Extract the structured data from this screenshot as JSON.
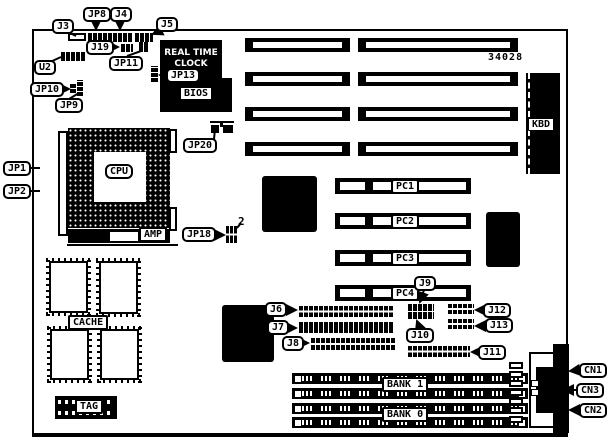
{
  "board": {
    "part_number": "34028",
    "silkscreen": {
      "rtc_line1": "REAL TIME",
      "rtc_line2": "CLOCK",
      "bios": "BIOS",
      "cpu": "CPU",
      "amp": "AMP",
      "kbd": "KBD",
      "cache": "CACHE",
      "tag": "TAG",
      "bank1": "BANK 1",
      "bank0": "BANK 0",
      "pin2": "2"
    },
    "connector_labels": {
      "j3": "J3",
      "jp8": "JP8",
      "j4": "J4",
      "j5": "J5",
      "j19": "J19",
      "jp11": "JP11",
      "u2": "U2",
      "jp10": "JP10",
      "jp9": "JP9",
      "jp13": "JP13",
      "jp20": "JP20",
      "jp1": "JP1",
      "jp2": "JP2",
      "jp18": "JP18",
      "pc1": "PC1",
      "pc2": "PC2",
      "pc3": "PC3",
      "pc4": "PC4",
      "j6": "J6",
      "j7": "J7",
      "j8": "J8",
      "j9": "J9",
      "j10": "J10",
      "j11": "J11",
      "j12": "J12",
      "j13": "J13",
      "cn1": "CN1",
      "cn2": "CN2",
      "cn3": "CN3"
    },
    "colors": {
      "ink": "#000000",
      "paper": "#ffffff"
    }
  }
}
